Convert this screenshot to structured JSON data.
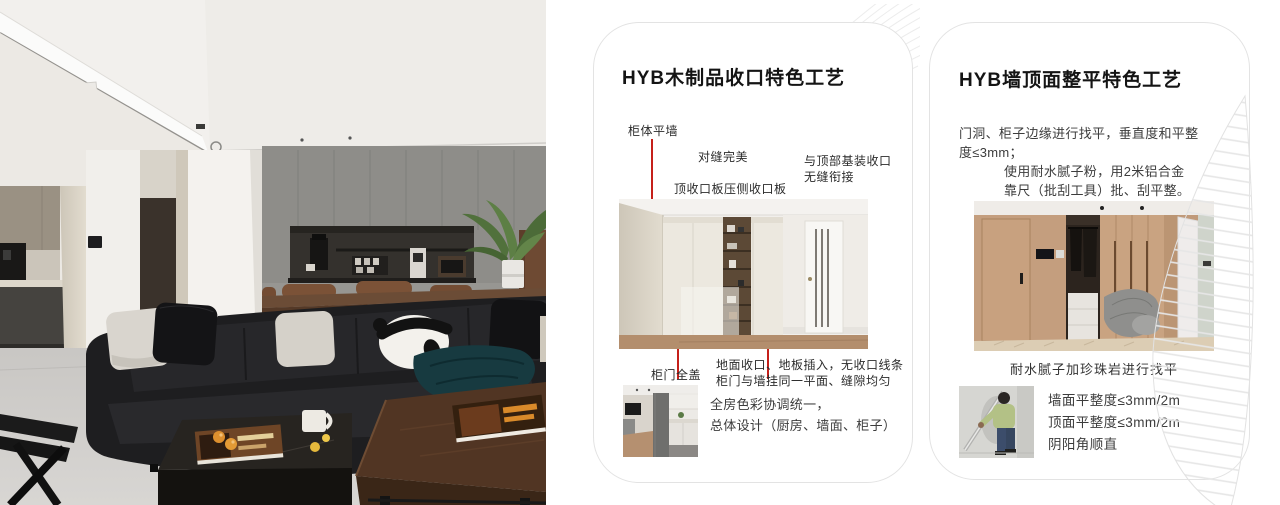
{
  "page": {
    "background": "#ffffff"
  },
  "colors": {
    "accent_red": "#c5201a",
    "card_border": "#e3e3e3",
    "title_text": "#141414",
    "body_text": "#3c3c3c",
    "decor_line": "#e9e9e9"
  },
  "photo": {
    "description": "modern living room: black leather sofa with panda cushion, grey cabinet wall with coffee niche, dining set, kitchen, wooden coffee tables"
  },
  "card1": {
    "title": "HYB木制品收口特色工艺",
    "callouts": {
      "cabinet_flush_wall": "柜体平墙",
      "perfect_seams": "对缝完美",
      "top_panel": "顶收口板压侧收口板",
      "ceiling_joint_line1": "与顶部基装收口",
      "ceiling_joint_line2": "无缝衔接",
      "full_cover_door": "柜门全盖",
      "floor_line1": "地面收口、地板插入，无收口线条",
      "floor_line2": "柜门与墙挂同一平面、缝隙均匀",
      "color_line1": "全房色彩协调统一，",
      "color_line2": "总体设计（厨房、墙面、柜子）"
    }
  },
  "card2": {
    "title": "HYB墙顶面整平特色工艺",
    "para1_line1": "门洞、柜子边缘进行找平，垂直度和平整",
    "para1_line2": "度≤3mm；",
    "para2_line1": "使用耐水腻子粉，用2米铝合金",
    "para2_line2": "靠尺（批刮工具）批、刮平整。",
    "caption": "耐水腻子加珍珠岩进行找平",
    "specs": [
      "墙面平整度≤3mm/2m",
      "顶面平整度≤3mm/2m",
      "阴阳角顺直"
    ]
  }
}
